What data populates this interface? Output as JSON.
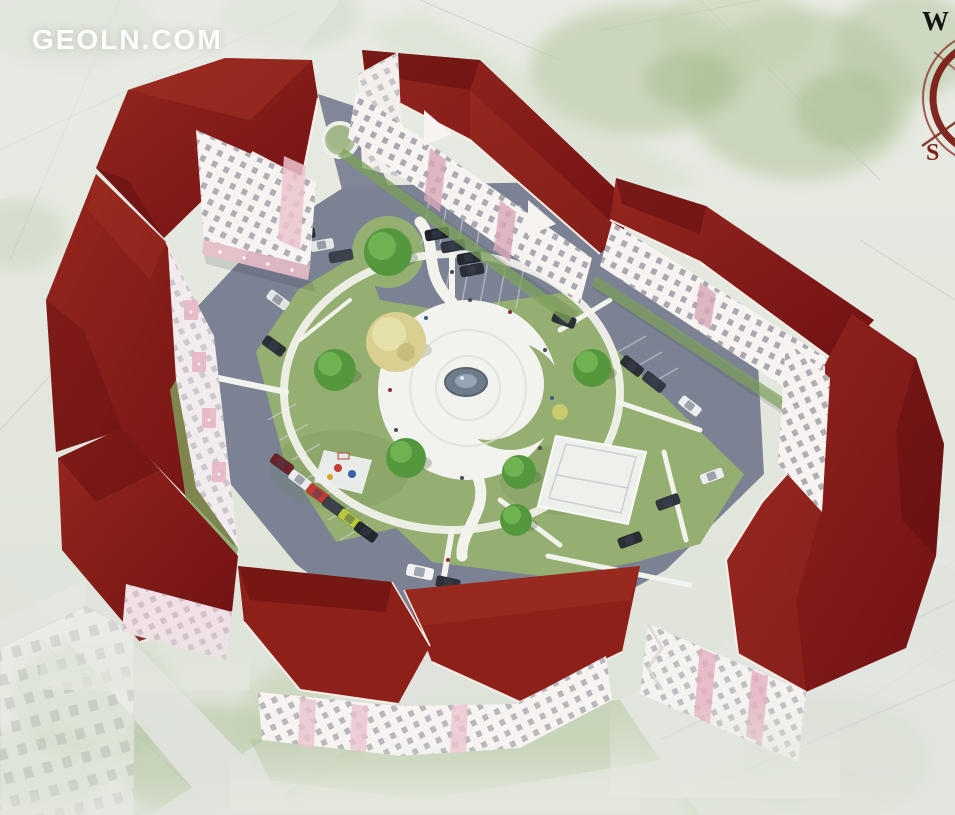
{
  "watermark": {
    "text": "GEOLN.COM"
  },
  "compass": {
    "west_label": "W",
    "south_label": "S"
  },
  "scene": {
    "description": "Aerial 3D architectural rendering of a residential complex: a ring of red-roofed apartment buildings enclosing a landscaped courtyard with a circular plaza and fountain, curved white walking paths, lawns, trees, a playground, a sports court, and parking areas with cars; faded streets, trees and neighbouring buildings around the edges."
  },
  "colors": {
    "roof_red": "#7a1517",
    "roof_red_light": "#a33124",
    "roof_red_dark": "#5f0e10",
    "facade_white": "#f6f3f0",
    "facade_shade": "#d9d4d2",
    "accent_pink": "#ecc4cf",
    "lawn_green": "#95ae71",
    "tree_green": "#55973d",
    "tree_yellow": "#d8cf90",
    "path_white": "#f3f3ee",
    "road_slate": "#7b8294",
    "background_sage": "#e4e8df",
    "fountain_blue": "#6e7b8a",
    "watermark_white": "#ffffff",
    "compass_dark_red": "#7a1e16"
  }
}
